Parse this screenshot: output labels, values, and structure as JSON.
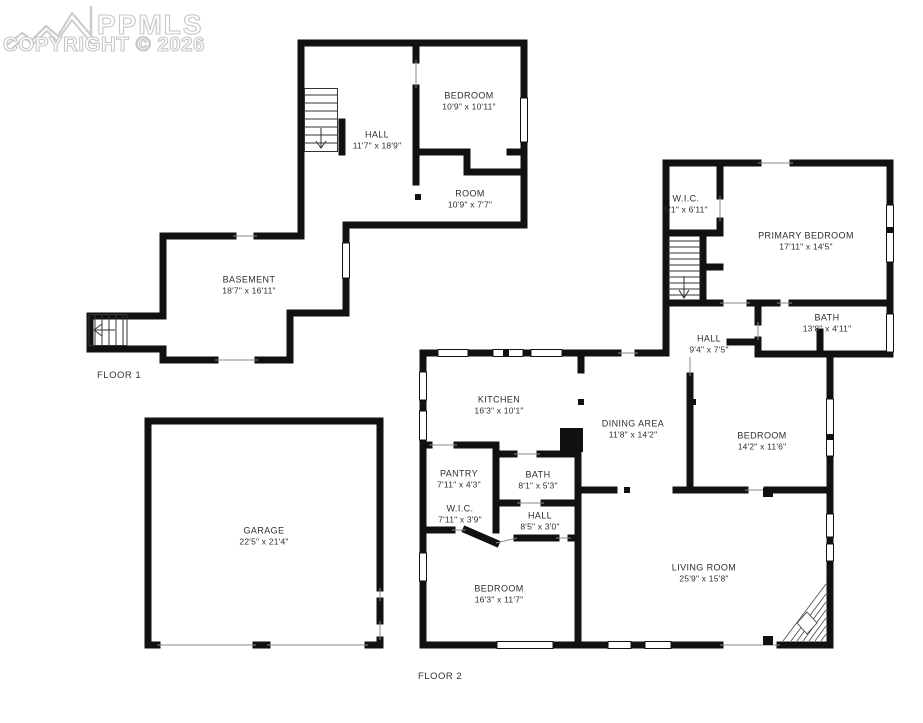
{
  "watermark": {
    "brand": "PPMLS",
    "copyright": "COPYRIGHT © 2026",
    "logo": "mountain-range-icon",
    "color": "#c6c6c6"
  },
  "colors": {
    "background": "#ffffff",
    "walls": "#111111",
    "label_text": "#2e2e2e"
  },
  "floor1": {
    "label": "FLOOR 1",
    "rooms": {
      "hall": {
        "name": "HALL",
        "dims": "11'7\" x 18'9\""
      },
      "bedroom": {
        "name": "BEDROOM",
        "dims": "10'9\" x 10'11\""
      },
      "room": {
        "name": "ROOM",
        "dims": "10'9\" x 7'7\""
      },
      "basement": {
        "name": "BASEMENT",
        "dims": "18'7\" x 16'11\""
      }
    }
  },
  "floor2": {
    "label": "FLOOR 2",
    "rooms": {
      "wic_upper": {
        "name": "W.I.C.",
        "dims": "5'1\" x 6'11\""
      },
      "primary_bedroom": {
        "name": "PRIMARY BEDROOM",
        "dims": "17'11\" x 14'5\""
      },
      "bath_upper": {
        "name": "BATH",
        "dims": "13'8\" x 4'11\""
      },
      "hall_upper": {
        "name": "HALL",
        "dims": "9'4\" x 7'5\""
      },
      "kitchen": {
        "name": "KITCHEN",
        "dims": "16'3\" x 10'1\""
      },
      "dining_area": {
        "name": "DINING AREA",
        "dims": "11'8\" x 14'2\""
      },
      "bedroom_ne": {
        "name": "BEDROOM",
        "dims": "14'2\" x 11'6\""
      },
      "pantry": {
        "name": "PANTRY",
        "dims": "7'11\" x 4'3\""
      },
      "bath_main": {
        "name": "BATH",
        "dims": "8'1\" x 5'3\""
      },
      "wic_main": {
        "name": "W.I.C.",
        "dims": "7'11\" x 3'9\""
      },
      "hall_main": {
        "name": "HALL",
        "dims": "8'5\" x 3'0\""
      },
      "bedroom_sw": {
        "name": "BEDROOM",
        "dims": "16'3\" x 11'7\""
      },
      "living_room": {
        "name": "LIVING ROOM",
        "dims": "25'9\" x 15'8\""
      }
    }
  },
  "garage": {
    "rooms": {
      "garage": {
        "name": "GARAGE",
        "dims": "22'5\" x 21'4\""
      }
    }
  }
}
